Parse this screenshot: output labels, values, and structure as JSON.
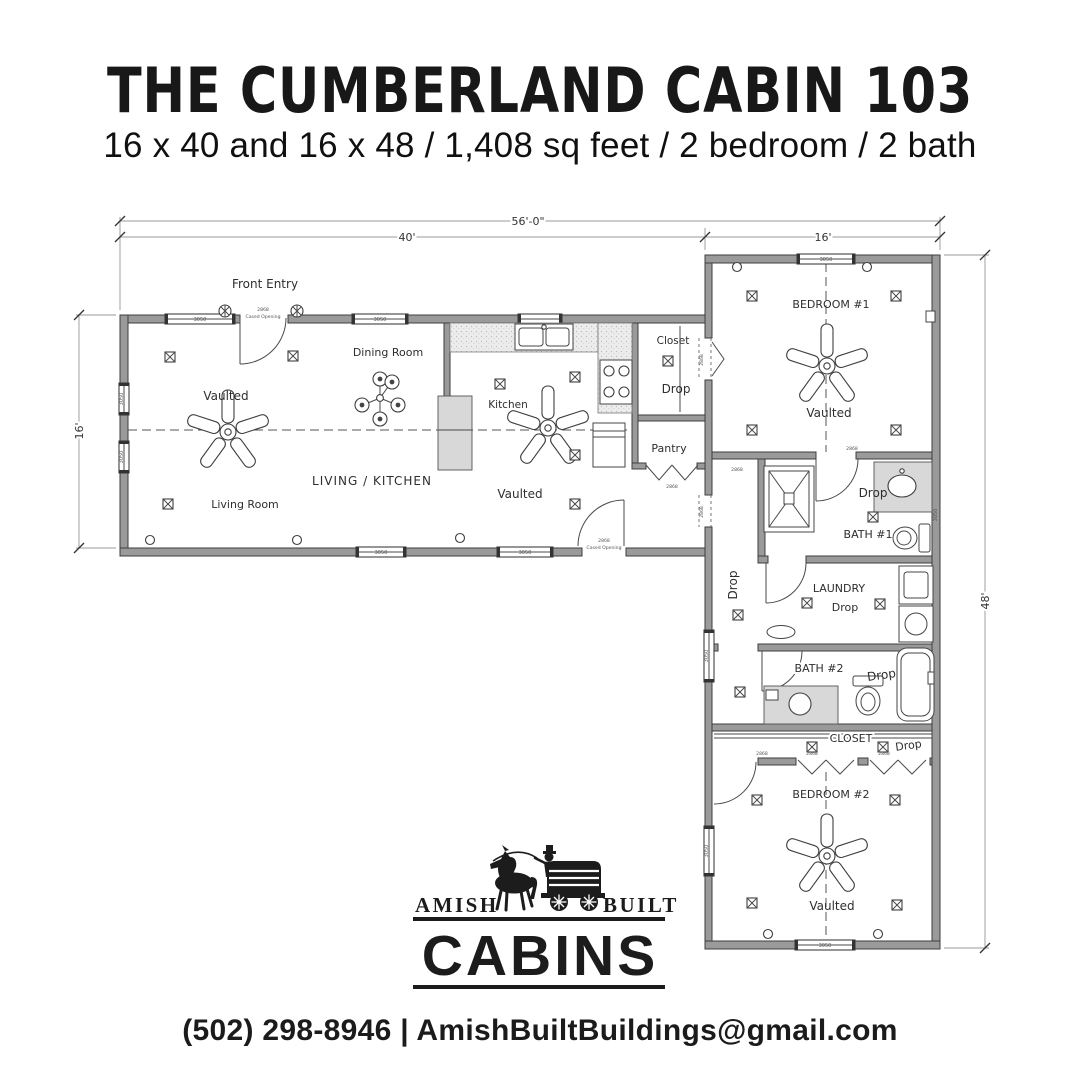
{
  "header": {
    "title": "THE CUMBERLAND CABIN 103",
    "subtitle": "16 x 40 and 16 x 48 / 1,408 sq feet / 2 bedroom / 2 bath"
  },
  "plan": {
    "rooms": {
      "front_entry": "Front Entry",
      "dining_room": "Dining Room",
      "kitchen": "Kitchen",
      "living_kitchen": "LIVING / KITCHEN",
      "living_room": "Living Room",
      "closet": "Closet",
      "pantry": "Pantry",
      "bedroom1": "BEDROOM #1",
      "bath1": "BATH #1",
      "laundry": "LAUNDRY",
      "bath2": "BATH #2",
      "closet2": "CLOSET",
      "bedroom2": "BEDROOM #2"
    },
    "notes": {
      "vaulted": "Vaulted",
      "drop": "Drop",
      "cased_opening": "Cased Opening"
    },
    "dimensions": {
      "overall_width": "56'-0\"",
      "left_wing_width": "40'",
      "right_wing_width": "16'",
      "left_wing_depth": "16'",
      "right_wing_length": "48'"
    },
    "callouts": {
      "window": "3050",
      "door": "2868"
    }
  },
  "logo": {
    "amish": "AMISH",
    "built": "BUILT",
    "cabins": "CABINS"
  },
  "footer": {
    "contact": "(502) 298-8946 | AmishBuiltBuildings@gmail.com"
  }
}
